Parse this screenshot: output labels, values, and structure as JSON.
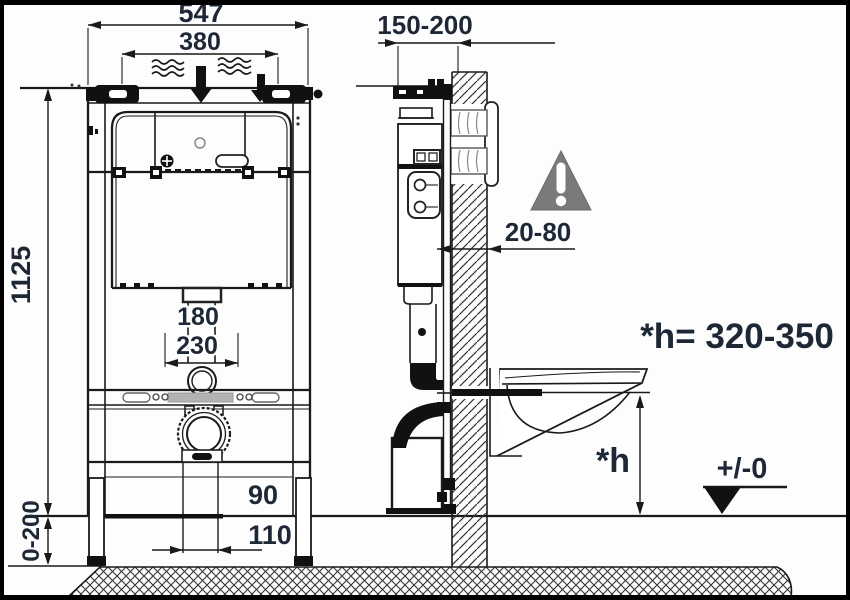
{
  "drawing": {
    "subject": "Concealed WC installation frame with cistern - dimensioned technical diagram",
    "views": {
      "left": "front view of frame",
      "right": "side view with wall and wall-hung bowl"
    }
  },
  "labels": {
    "frame_width": "547",
    "inner_top_width": "380",
    "frame_height": "1125",
    "leg_adjustment": "0-200",
    "depth_range": "150-200",
    "wall_clearance": "20-80",
    "outlet_offset_small": "180",
    "outlet_offset_large": "230",
    "drain_small": "90",
    "drain_large": "110",
    "seat_height_formula": "*h= 320-350",
    "seat_height_symbol": "*h",
    "floor_level": "+/-0"
  },
  "icons": {
    "warning_triangle": "gray warning triangle with exclamation mark",
    "water_flow": "wavy water lines with two black down arrows",
    "level_mark": "filled black datum triangle at floor level"
  },
  "colors": {
    "line": "#1a1a1a",
    "dimension_text": "#1d2736",
    "warning_gray": "#7a7a78",
    "gray_bar": "#b3b3b3",
    "border": "#000000"
  }
}
